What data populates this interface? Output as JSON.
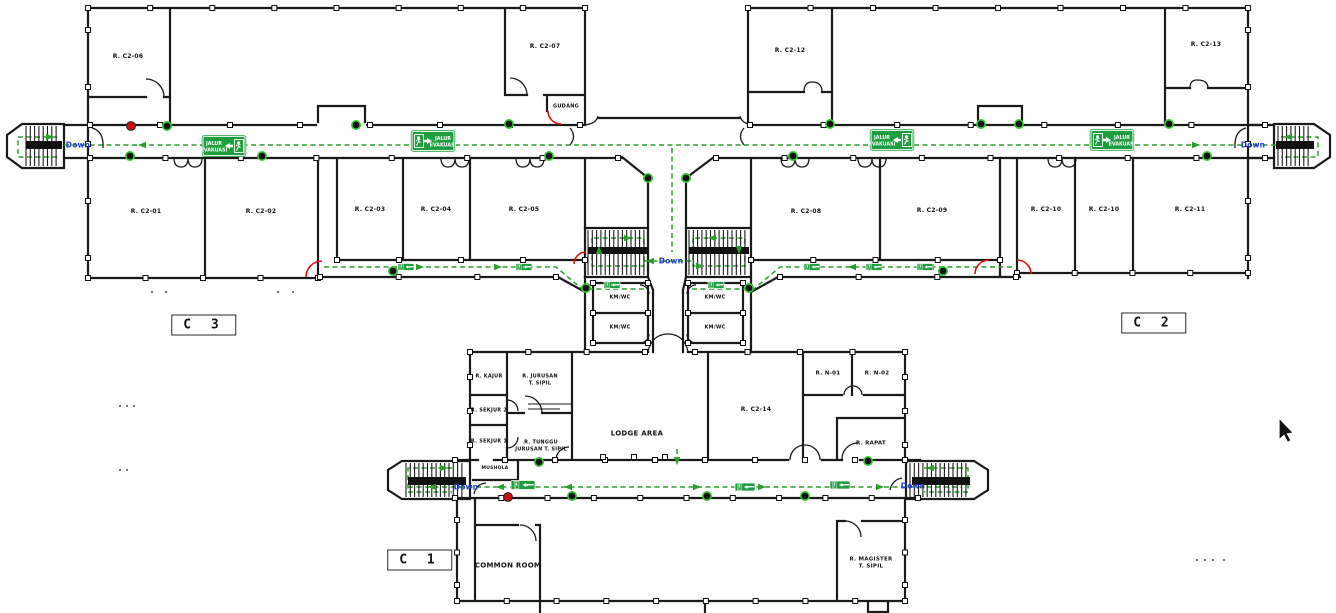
{
  "page": {
    "background": "#ffffff",
    "type": "evacuation-floor-plan"
  },
  "blocks": [
    {
      "label": "C 3"
    },
    {
      "label": "C 2"
    },
    {
      "label": "C 1"
    }
  ],
  "labels": {
    "down": "Down"
  },
  "signs": {
    "line1": "JALUR",
    "line2": "EVAKUASI"
  },
  "rooms": [
    {
      "label": "R. C2-06"
    },
    {
      "label": "R. C2-07"
    },
    {
      "label": "GUDANG"
    },
    {
      "label": "R. C2-01"
    },
    {
      "label": "R. C2-02"
    },
    {
      "label": "R. C2-03"
    },
    {
      "label": "R. C2-04"
    },
    {
      "label": "R. C2-05"
    },
    {
      "label": "KM/WC"
    },
    {
      "label": "KM/WC"
    },
    {
      "label": "KM/WC"
    },
    {
      "label": "KM/WC"
    },
    {
      "label": "R. C2-12"
    },
    {
      "label": "R. C2-13"
    },
    {
      "label": "R. C2-08"
    },
    {
      "label": "R. C2-09"
    },
    {
      "label": "R. C2-10"
    },
    {
      "label": "R. C2-10"
    },
    {
      "label": "R. C2-11"
    },
    {
      "label": "R. KAJUR"
    },
    {
      "label": "R. JURUSAN\nT. SIPIL"
    },
    {
      "label": "R. SEKJUR 2"
    },
    {
      "label": "R. SEKJUR 1"
    },
    {
      "label": "R. TUNGGU\nJURUSAN T. SIPIL"
    },
    {
      "label": "MUSHOLA"
    },
    {
      "label": "LODGE AREA"
    },
    {
      "label": "R. C2-14"
    },
    {
      "label": "R. N-01"
    },
    {
      "label": "R. N-02"
    },
    {
      "label": "R. RAPAT"
    },
    {
      "label": "COMMON ROOM"
    },
    {
      "label": "R. MAGISTER\nT. SIPIL"
    }
  ],
  "colors": {
    "wall": "#1a1a1a",
    "route_green": "#2aa02a",
    "sign_green": "#1f9e3f",
    "down_blue": "#2038d5",
    "alarm_red": "#dd1111"
  }
}
